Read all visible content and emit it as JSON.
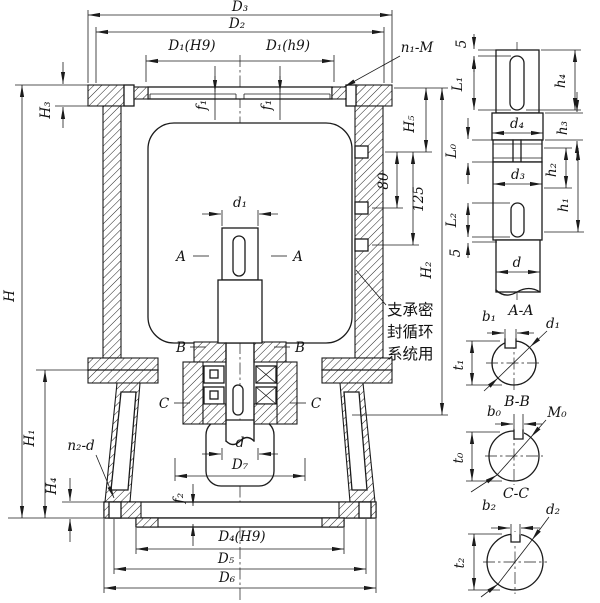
{
  "main": {
    "D3": "D₃",
    "D2": "D₂",
    "D1H9": "D₁(H9)",
    "D1h9": "D₁(h9)",
    "n1M": "n₁-M",
    "f1": "f₁",
    "H3": "H₃",
    "H": "H",
    "H1": "H₁",
    "H4": "H₄",
    "n2d": "n₂-d",
    "f2": "f₂",
    "d1": "d₁",
    "d": "d",
    "D7": "D₇",
    "D4H9": "D₄(H9)",
    "D5": "D₅",
    "D6": "D₆",
    "H5": "H₅",
    "n80": "80",
    "n125": "125",
    "H2": "H₂",
    "A": "A",
    "B": "B",
    "C": "C",
    "note1": "支承密",
    "note2": "封循环",
    "note3": "系统用"
  },
  "shaft": {
    "top5": "5",
    "L1": "L₁",
    "h4": "h₄",
    "d4": "d₄",
    "h3": "h₃",
    "L0": "L₀",
    "h2": "h₂",
    "d3": "d₃",
    "h1": "h₁",
    "L2": "L₂",
    "bot5": "5",
    "d": "d"
  },
  "sec": {
    "AAtitle": "A-A",
    "b1": "b₁",
    "d1": "d₁",
    "t1": "t₁",
    "BBtitle": "B-B",
    "b0": "b₀",
    "M0": "M₀",
    "t0": "t₀",
    "CCtitle": "C-C",
    "b2": "b₂",
    "d2": "d₂",
    "t2": "t₂"
  }
}
